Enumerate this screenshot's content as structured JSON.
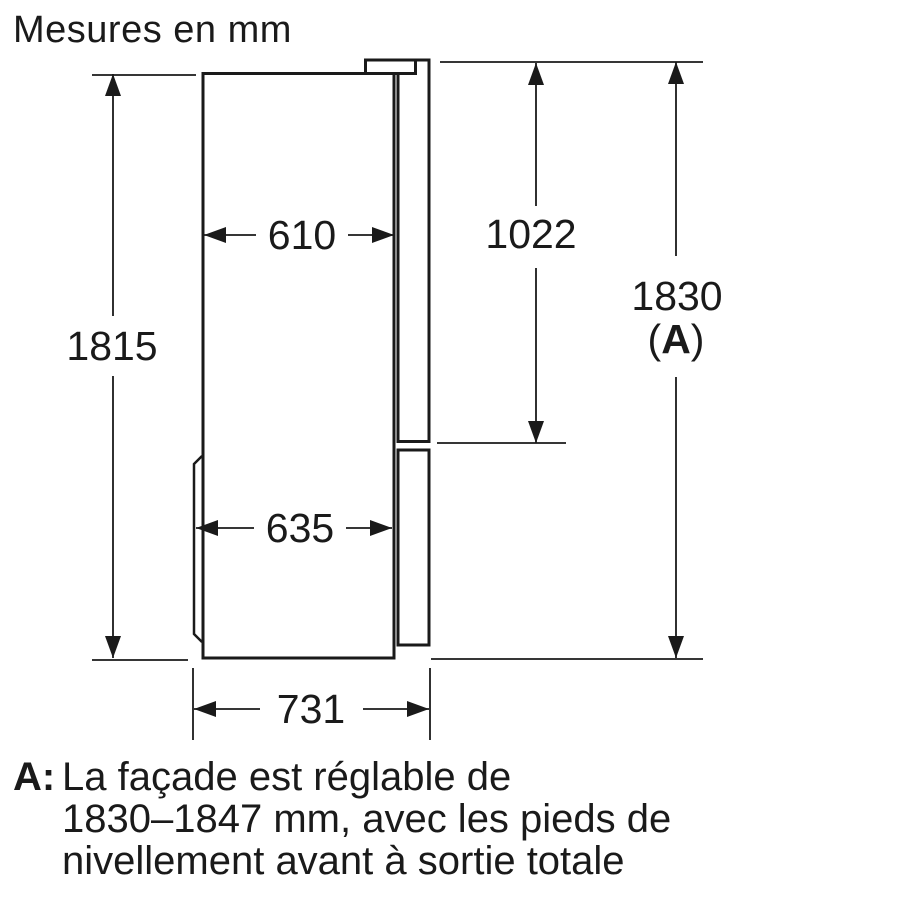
{
  "title": "Mesures en mm",
  "colors": {
    "ink": "#1a1a1a",
    "paper": "#ffffff"
  },
  "dims": {
    "body_height": {
      "value": "1815"
    },
    "top_depth": {
      "value": "610"
    },
    "upper_door_height": {
      "value": "1022"
    },
    "total_height": {
      "value": "1830",
      "ref_open": "(",
      "ref_letter": "A",
      "ref_close": ")"
    },
    "bottom_depth": {
      "value": "635"
    },
    "total_depth": {
      "value": "731"
    }
  },
  "footnote": {
    "ref": "A:",
    "lines": [
      "La façade est réglable de",
      "1830–1847 mm, avec les pieds de",
      "nivellement avant à sortie totale"
    ]
  }
}
